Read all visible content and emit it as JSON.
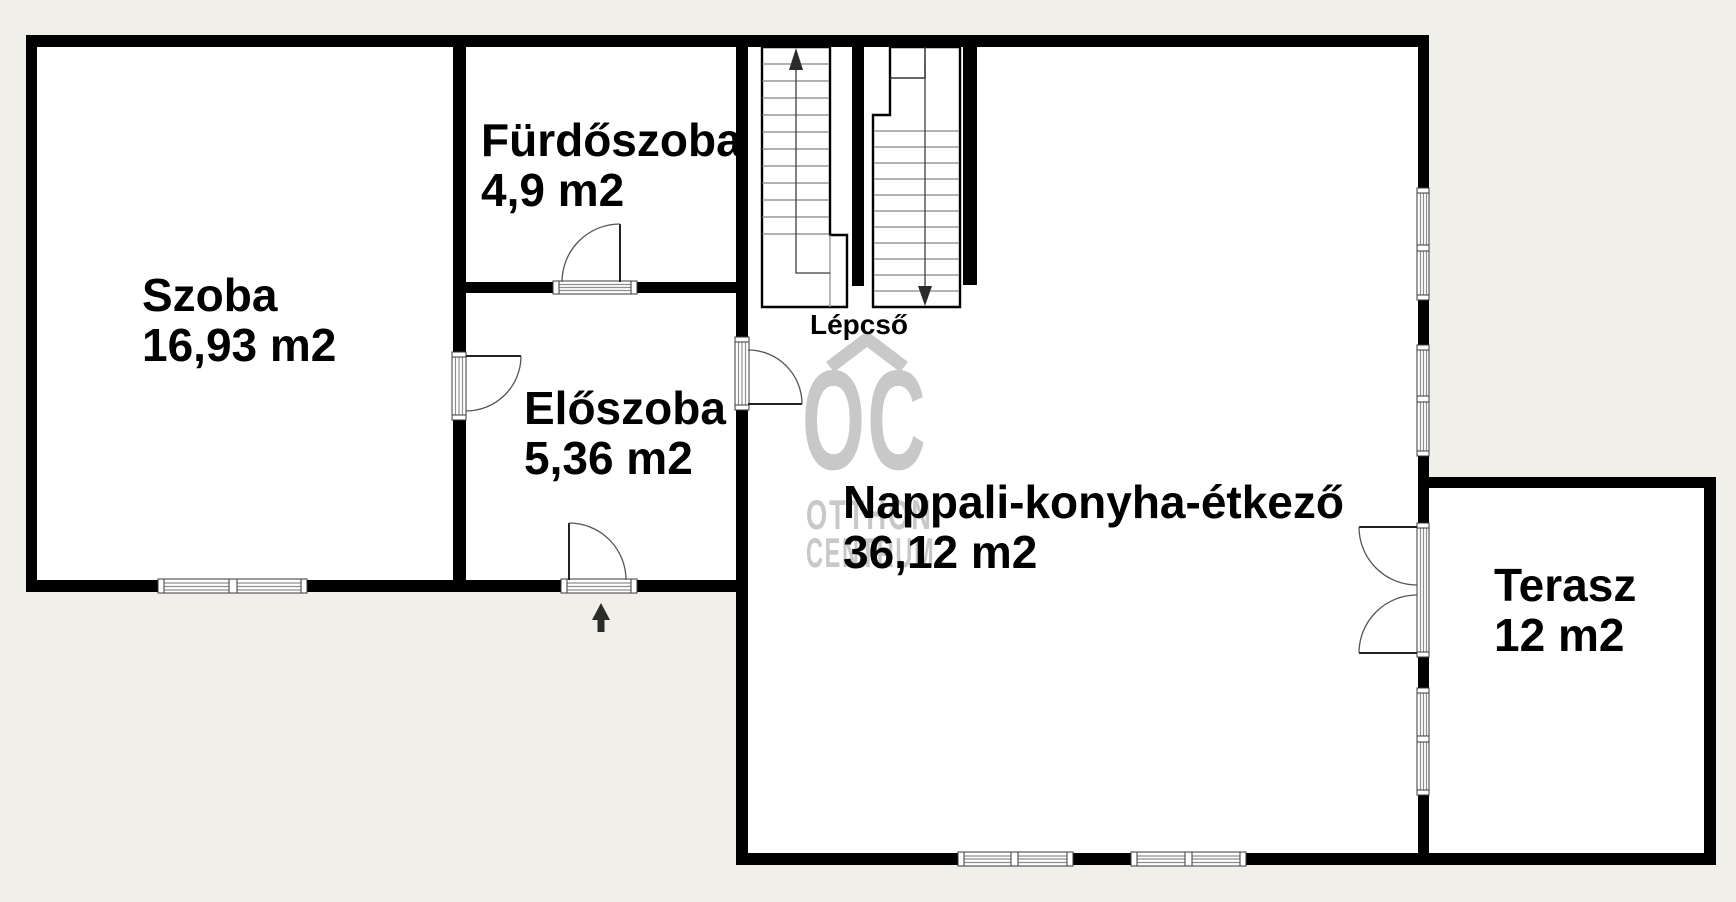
{
  "rooms": {
    "szoba": {
      "name": "Szoba",
      "area": "16,93 m2"
    },
    "furdoszoba": {
      "name": "Fürdőszoba",
      "area": "4,9 m2"
    },
    "eloszoba": {
      "name": "Előszoba",
      "area": "5,36 m2"
    },
    "nappali": {
      "name": "Nappali-konyha-étkező",
      "area": "36,12 m2"
    },
    "terasz": {
      "name": "Terasz",
      "area": "12 m2"
    }
  },
  "stairs": {
    "label": "Lépcső"
  },
  "watermark": {
    "logo": "OC",
    "line1": "OTTHON",
    "line2": "CENTRUM"
  },
  "colors": {
    "wall": "#000000",
    "background": "#f0efea",
    "interior": "#ffffff",
    "watermark": "#c8c8c8"
  }
}
